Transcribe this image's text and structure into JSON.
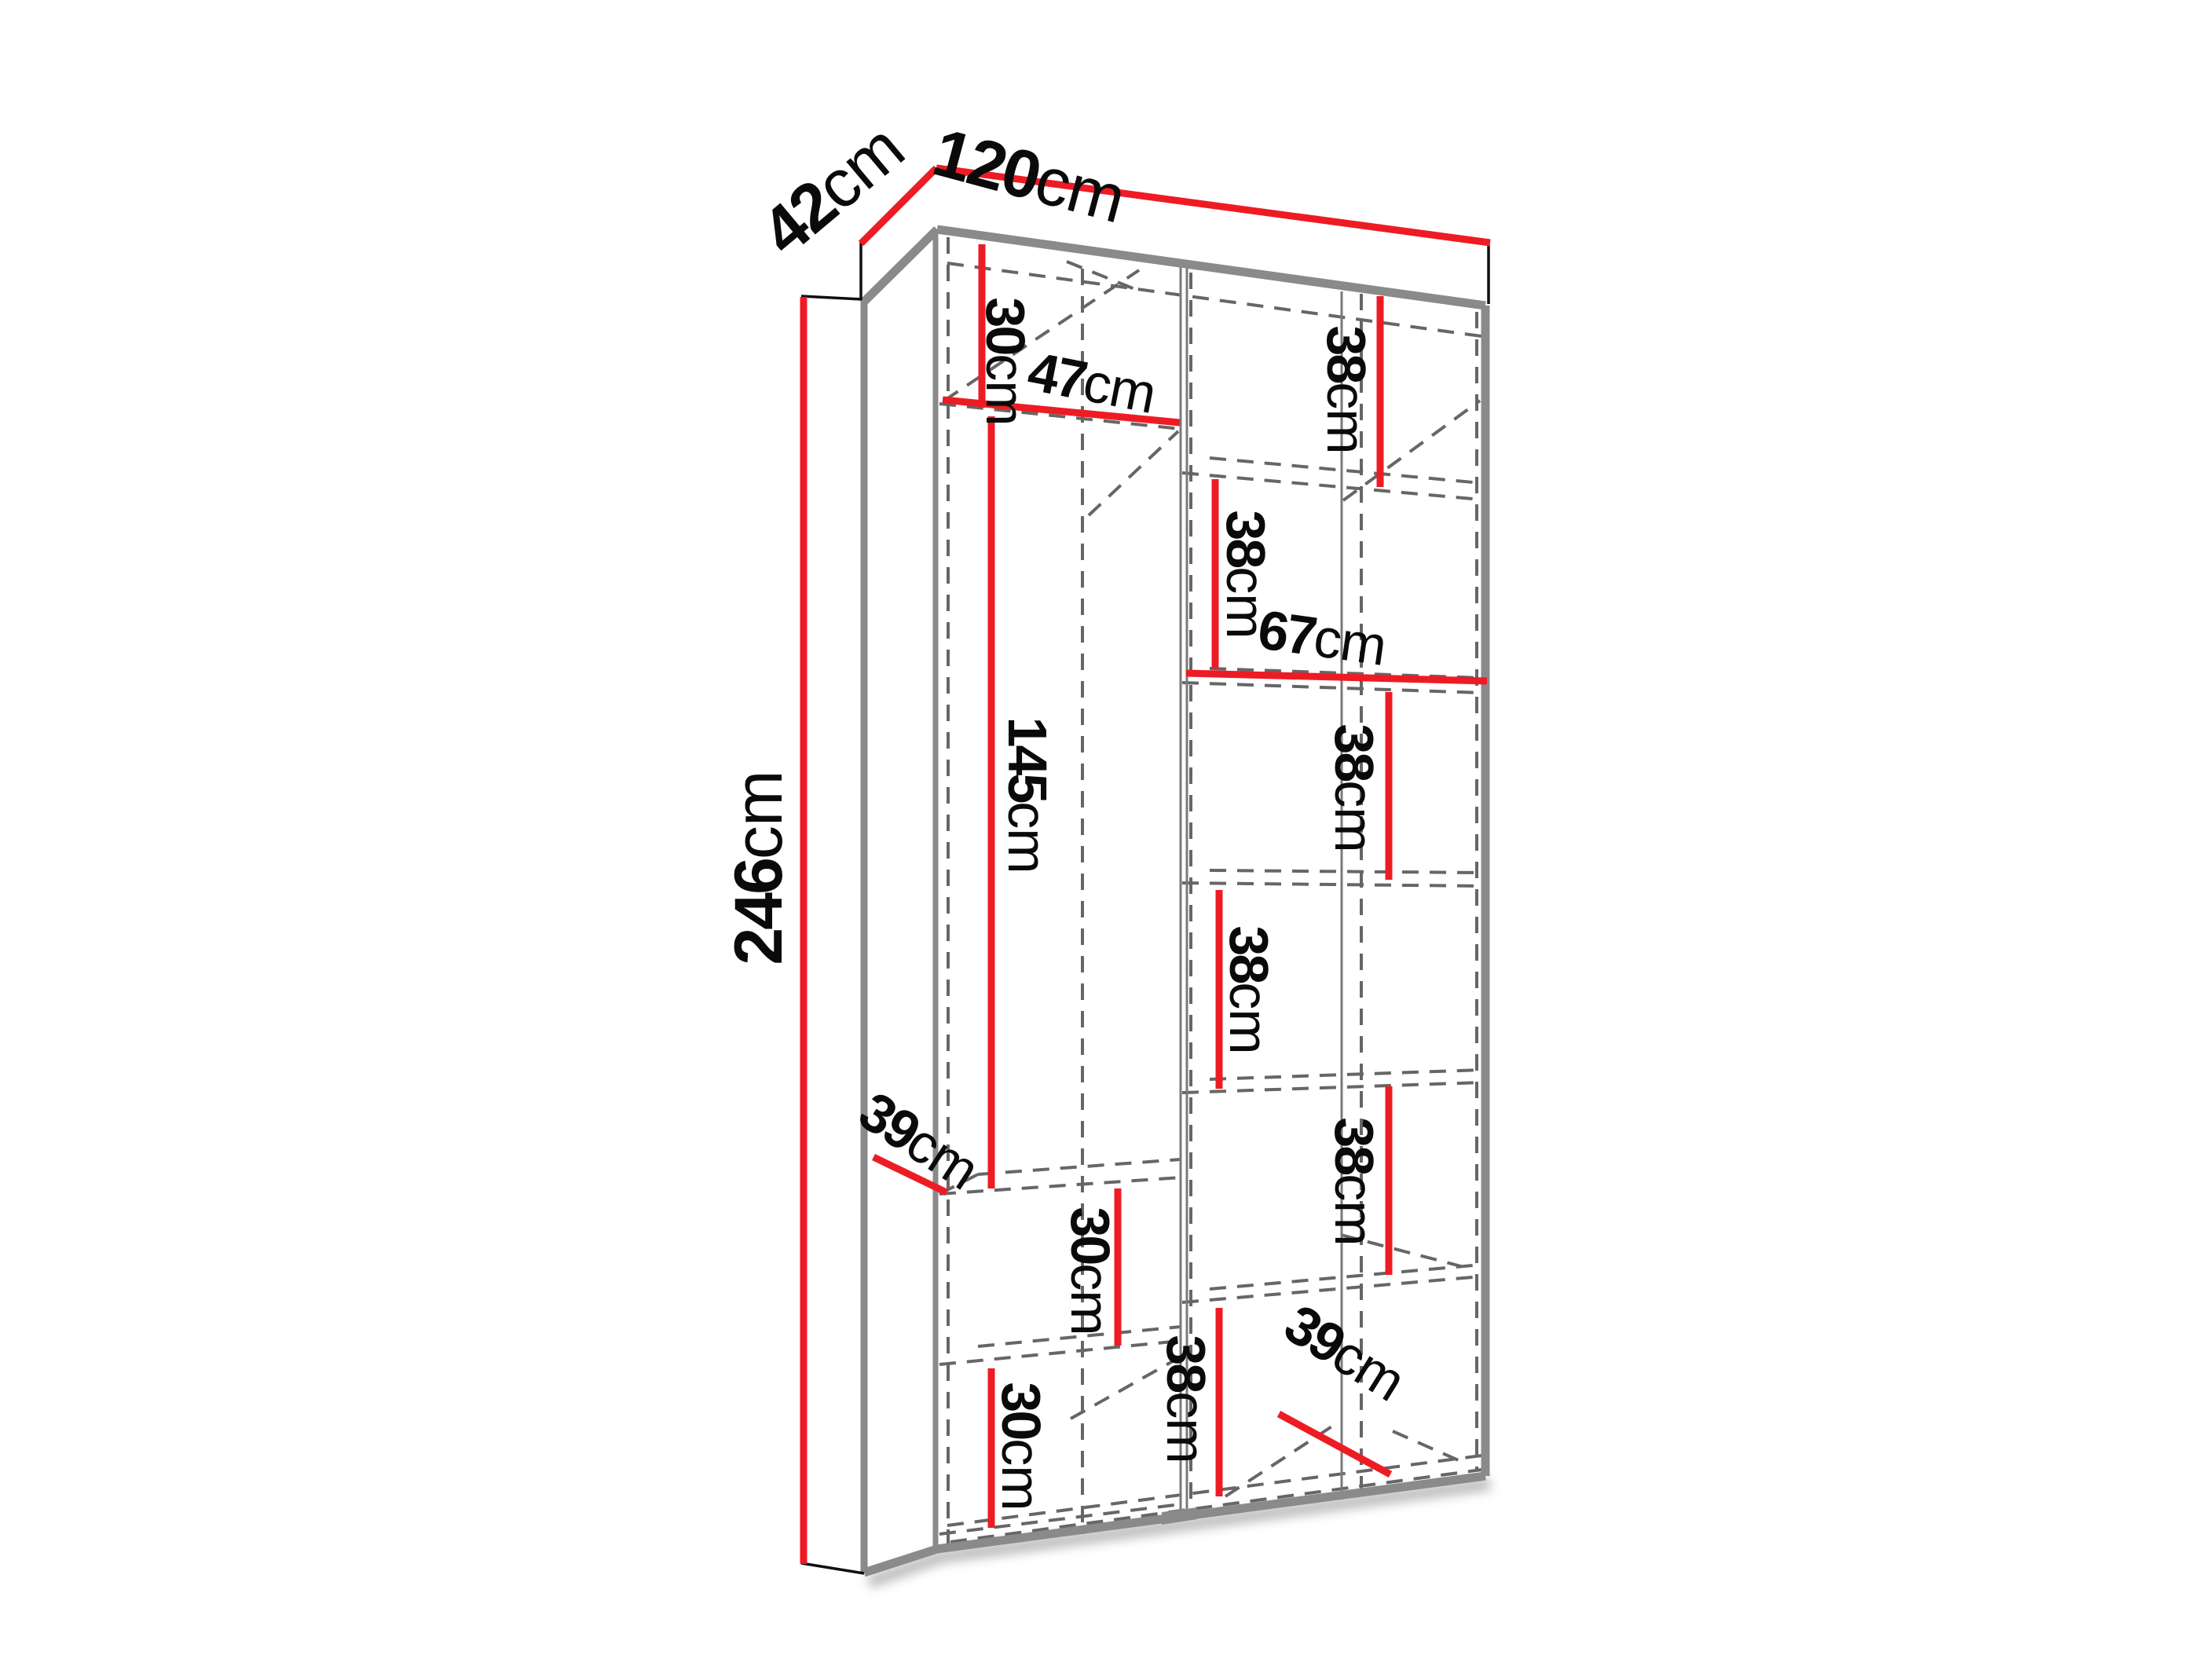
{
  "diagram": {
    "type": "furniture dimension diagram",
    "subject": "wardrobe interior with shelves and dimension lines",
    "unit": "cm",
    "background": "#ffffff",
    "colors": {
      "dimension_line": "#ed1c24",
      "text": "#0a0a0a",
      "edge_gray": "#8a8a8a",
      "dashed_gray": "#666666"
    },
    "overall": {
      "width": "120cm",
      "depth": "42cm",
      "height": "246cm"
    },
    "labels": {
      "depth42": {
        "num": "42",
        "unit": "cm"
      },
      "width120": {
        "num": "120",
        "unit": "cm"
      },
      "height246": {
        "num": "246",
        "unit": "cm"
      },
      "top30": {
        "num": "30",
        "unit": "cm"
      },
      "left47": {
        "num": "47",
        "unit": "cm"
      },
      "right38a": {
        "num": "38",
        "unit": "cm"
      },
      "mid38b": {
        "num": "38",
        "unit": "cm"
      },
      "right67": {
        "num": "67",
        "unit": "cm"
      },
      "hang145": {
        "num": "145",
        "unit": "cm"
      },
      "right38c": {
        "num": "38",
        "unit": "cm"
      },
      "mid38d": {
        "num": "38",
        "unit": "cm"
      },
      "right38e": {
        "num": "38",
        "unit": "cm"
      },
      "depth39L": {
        "num": "39",
        "unit": "cm"
      },
      "mid30a": {
        "num": "30",
        "unit": "cm"
      },
      "bottom30b": {
        "num": "30",
        "unit": "cm"
      },
      "mid38f": {
        "num": "38",
        "unit": "cm"
      },
      "depth39R": {
        "num": "39",
        "unit": "cm"
      }
    }
  }
}
